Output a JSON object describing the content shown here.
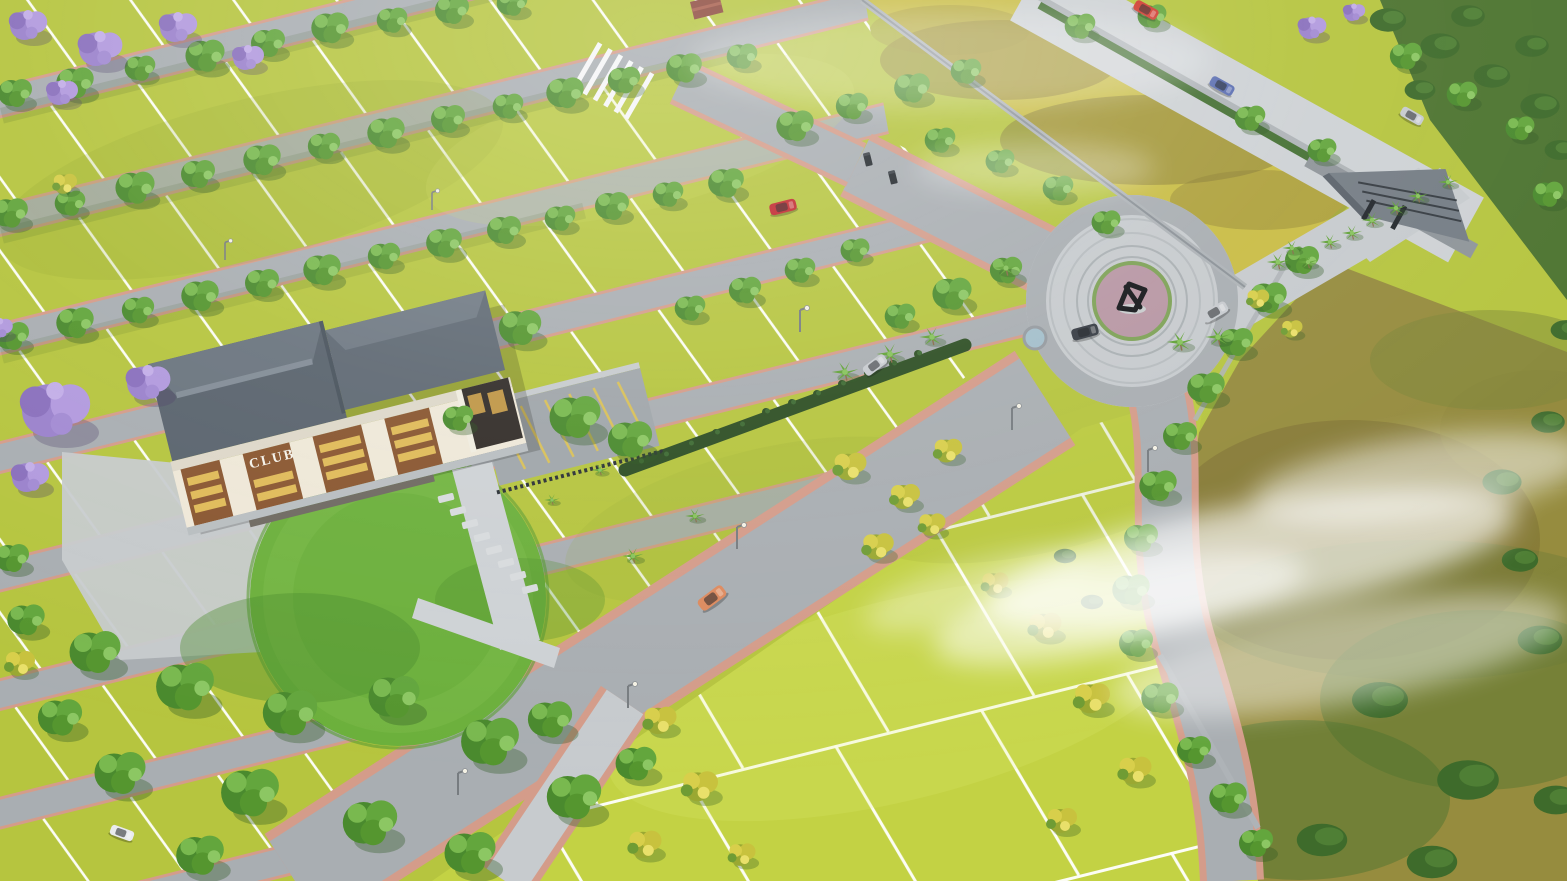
{
  "scene": {
    "description": "Aerial 3D render of a gated plotted land development with clubhouse, roundabout sculpture, entrance gate, tree-lined roads and open plots",
    "club_sign": "CLUB"
  },
  "palette": {
    "plot": "#b6c53f",
    "plot2": "#c3d244",
    "road": "#a9aeb2",
    "pave": "#c7cbce",
    "paveLight": "#ced2d5",
    "edge": "#d49c8a",
    "lawn": "#6cb03c",
    "lawnDark": "#4c8c2c",
    "roof": "#5a646e",
    "roofLight": "#6b757f",
    "ridge": "#838d97",
    "fascia": "#ded8c9",
    "facade": "#efe8d8",
    "panelBrown": "#8a5731",
    "window": "#e9c75e",
    "porch": "#332e2a",
    "wall": "#aeb3b7",
    "wallDark": "#7e858b",
    "terrain": "#968c3e",
    "terrainBrown": "#7d6f33",
    "forest": "#4d7430",
    "hedge": "#3e6b2b",
    "treeDark": "#4a8a2e",
    "treeMid": "#63a63d",
    "treeLight": "#8cc763",
    "yellowTree": "#d8cf4b",
    "palm": "#61a337",
    "jacaranda": "#a38bd3",
    "flowerbed": "#b897a4",
    "sculpture": "#16181b",
    "pond": "#a4bfcb",
    "median": "#2e4f24",
    "fence": "#2c3136",
    "stall": "#d8c05a",
    "stone": "#d8dbdd",
    "signText": "#f5f2ea",
    "mist": "#ffffff",
    "carRed": "#c1272d",
    "carRed2": "#d03a2e",
    "carBlue": "#5c6fb2",
    "carSilver": "#c7cbcf",
    "carOrange": "#dd8a5e",
    "carDark": "#383d44",
    "carWhite": "#e9ebee"
  },
  "objects": {
    "clubhouse": {
      "sign": "CLUB",
      "roof": "gray hip roof",
      "facade": "cream with brown panels and lit windows"
    },
    "roundabout": {
      "feature": "dark abstract sculpture on flower island"
    },
    "entrance_gate": {
      "style": "angular gray canopy with palm-lined driveway"
    },
    "cars": [
      {
        "name": "car-red",
        "location": "plot road"
      },
      {
        "name": "car-orange",
        "location": "main avenue"
      },
      {
        "name": "car-silver-avenue",
        "location": "main avenue"
      },
      {
        "name": "car-dark",
        "location": "roundabout"
      },
      {
        "name": "car-silver-roundabout",
        "location": "roundabout exit"
      },
      {
        "name": "car-red-external",
        "location": "external road"
      },
      {
        "name": "car-blue-external",
        "location": "external road"
      },
      {
        "name": "car-silver-external",
        "location": "external road"
      },
      {
        "name": "car-white-parked",
        "location": "clubhouse path"
      }
    ]
  },
  "stamps": [
    {
      "layer": "median-shrubs",
      "symbol": "#shrubS",
      "name": "median-shrub",
      "items": [
        [
          640,
          462,
          0.5
        ],
        [
          665,
          455,
          0.5
        ],
        [
          690,
          444,
          0.5
        ],
        [
          716,
          433,
          0.5
        ],
        [
          741,
          425,
          0.5
        ],
        [
          766,
          412,
          0.5
        ],
        [
          792,
          403,
          0.5
        ],
        [
          817,
          394,
          0.5
        ],
        [
          842,
          384,
          0.5
        ],
        [
          868,
          373,
          0.5
        ],
        [
          893,
          364,
          0.5
        ],
        [
          918,
          354,
          0.5
        ]
      ]
    },
    {
      "layer": "stepping-stones",
      "symbol": "#stone",
      "name": "stepping-stone",
      "items": [
        [
          446,
          498
        ],
        [
          458,
          511
        ],
        [
          470,
          524
        ],
        [
          482,
          537
        ],
        [
          494,
          550
        ],
        [
          506,
          563
        ],
        [
          518,
          576
        ],
        [
          530,
          589
        ]
      ]
    },
    {
      "layer": "green-trees",
      "symbol": "#treeG",
      "name": "green-tree",
      "items": [
        [
          15,
          95,
          1
        ],
        [
          75,
          85,
          1.1
        ],
        [
          140,
          70,
          0.9
        ],
        [
          205,
          58,
          1.15
        ],
        [
          268,
          45,
          1
        ],
        [
          330,
          30,
          1.1
        ],
        [
          392,
          22,
          0.9
        ],
        [
          452,
          12,
          1
        ],
        [
          512,
          5,
          0.9
        ],
        [
          10,
          215,
          1.05
        ],
        [
          70,
          205,
          0.9
        ],
        [
          135,
          190,
          1.15
        ],
        [
          198,
          176,
          1
        ],
        [
          262,
          162,
          1.1
        ],
        [
          324,
          148,
          0.95
        ],
        [
          386,
          135,
          1.1
        ],
        [
          448,
          121,
          1
        ],
        [
          508,
          108,
          0.9
        ],
        [
          565,
          95,
          1.1
        ],
        [
          624,
          82,
          0.95
        ],
        [
          684,
          70,
          1.05
        ],
        [
          742,
          58,
          0.9
        ],
        [
          12,
          338,
          1
        ],
        [
          75,
          325,
          1.1
        ],
        [
          138,
          312,
          0.95
        ],
        [
          200,
          298,
          1.1
        ],
        [
          262,
          285,
          1
        ],
        [
          322,
          272,
          1.1
        ],
        [
          384,
          258,
          0.95
        ],
        [
          444,
          245,
          1.05
        ],
        [
          504,
          232,
          1
        ],
        [
          560,
          220,
          0.9
        ],
        [
          612,
          208,
          1
        ],
        [
          668,
          196,
          0.9
        ],
        [
          726,
          185,
          1.05
        ],
        [
          795,
          128,
          1.1
        ],
        [
          852,
          108,
          0.95
        ],
        [
          912,
          90,
          1.05
        ],
        [
          966,
          73,
          0.9
        ],
        [
          940,
          142,
          0.9
        ],
        [
          1000,
          163,
          0.85
        ],
        [
          1058,
          190,
          0.9
        ],
        [
          1106,
          224,
          0.85
        ],
        [
          690,
          310,
          0.9
        ],
        [
          745,
          292,
          0.95
        ],
        [
          800,
          272,
          0.9
        ],
        [
          855,
          252,
          0.85
        ],
        [
          520,
          330,
          1.25
        ],
        [
          575,
          420,
          1.5
        ],
        [
          630,
          442,
          1.3
        ],
        [
          458,
          420,
          0.9
        ],
        [
          900,
          318,
          0.9
        ],
        [
          952,
          296,
          1.15
        ],
        [
          1006,
          272,
          0.95
        ],
        [
          1080,
          28,
          0.9
        ],
        [
          1152,
          18,
          0.85
        ],
        [
          1250,
          120,
          0.9
        ],
        [
          1322,
          152,
          0.85
        ],
        [
          1406,
          58,
          0.95
        ],
        [
          1462,
          96,
          0.9
        ],
        [
          1520,
          130,
          0.85
        ],
        [
          1548,
          196,
          0.9
        ],
        [
          1302,
          262,
          1
        ],
        [
          1268,
          300,
          1.1
        ],
        [
          1236,
          344,
          1
        ],
        [
          1206,
          390,
          1.1
        ],
        [
          1180,
          438,
          1
        ],
        [
          1158,
          488,
          1.1
        ],
        [
          1141,
          540,
          1
        ],
        [
          1131,
          592,
          1.1
        ],
        [
          1136,
          645,
          1
        ],
        [
          1160,
          700,
          1.1
        ],
        [
          1194,
          752,
          1
        ],
        [
          1228,
          800,
          1.1
        ],
        [
          1256,
          845,
          1
        ],
        [
          95,
          655,
          1.5
        ],
        [
          185,
          690,
          1.7
        ],
        [
          290,
          716,
          1.6
        ],
        [
          394,
          700,
          1.5
        ],
        [
          490,
          745,
          1.7
        ],
        [
          574,
          800,
          1.6
        ],
        [
          250,
          796,
          1.7
        ],
        [
          370,
          826,
          1.6
        ],
        [
          120,
          776,
          1.5
        ],
        [
          200,
          858,
          1.4
        ],
        [
          470,
          856,
          1.5
        ],
        [
          60,
          720,
          1.3
        ],
        [
          550,
          722,
          1.3
        ],
        [
          636,
          766,
          1.2
        ],
        [
          12,
          560,
          1
        ],
        [
          26,
          622,
          1.1
        ]
      ]
    },
    {
      "layer": "yellow-trees",
      "symbol": "#treeY",
      "name": "yellow-flowering-tree",
      "items": [
        [
          850,
          468,
          1.1
        ],
        [
          905,
          498,
          1
        ],
        [
          948,
          452,
          0.95
        ],
        [
          878,
          548,
          1.05
        ],
        [
          932,
          526,
          0.9
        ],
        [
          995,
          585,
          0.9
        ],
        [
          660,
          722,
          1.1
        ],
        [
          700,
          788,
          1.2
        ],
        [
          645,
          846,
          1.1
        ],
        [
          742,
          856,
          0.9
        ],
        [
          1045,
          628,
          1.1
        ],
        [
          1092,
          700,
          1.2
        ],
        [
          1135,
          772,
          1.1
        ],
        [
          1062,
          822,
          1
        ],
        [
          20,
          665,
          1
        ],
        [
          65,
          185,
          0.8
        ],
        [
          1258,
          300,
          0.75
        ],
        [
          1292,
          330,
          0.7
        ]
      ]
    },
    {
      "layer": "palm-trees",
      "symbol": "#palm",
      "name": "palm-tree",
      "items": [
        [
          845,
          372,
          0.95
        ],
        [
          890,
          354,
          0.95
        ],
        [
          932,
          337,
          0.9
        ],
        [
          1006,
          268,
          0.85
        ],
        [
          1180,
          342,
          0.95
        ],
        [
          1218,
          337,
          0.9
        ],
        [
          1278,
          262,
          0.8
        ],
        [
          1292,
          248,
          0.7
        ],
        [
          1308,
          262,
          0.7
        ],
        [
          1330,
          242,
          0.72
        ],
        [
          1352,
          233,
          0.72
        ],
        [
          1372,
          220,
          0.74
        ],
        [
          1396,
          208,
          0.74
        ],
        [
          1418,
          196,
          0.72
        ],
        [
          1448,
          182,
          0.7
        ],
        [
          633,
          556,
          0.75
        ],
        [
          695,
          516,
          0.7
        ],
        [
          600,
          470,
          0.6
        ],
        [
          552,
          500,
          0.55
        ]
      ]
    },
    {
      "layer": "jacaranda-trees",
      "symbol": "#jac",
      "name": "jacaranda-tree",
      "items": [
        [
          28,
          28,
          1.2
        ],
        [
          100,
          52,
          1.4
        ],
        [
          178,
          30,
          1.2
        ],
        [
          248,
          60,
          1
        ],
        [
          62,
          95,
          1
        ],
        [
          0,
          330,
          0.8
        ],
        [
          55,
          415,
          2.2
        ],
        [
          148,
          386,
          1.4
        ],
        [
          30,
          480,
          1.2
        ],
        [
          1312,
          30,
          0.9
        ],
        [
          1354,
          14,
          0.7
        ]
      ]
    },
    {
      "layer": "hedge-blobs",
      "symbol": "#hedgeB",
      "name": "hedge",
      "items": [
        [
          1388,
          20,
          1.3
        ],
        [
          1440,
          46,
          1.4
        ],
        [
          1492,
          76,
          1.3
        ],
        [
          1540,
          106,
          1.4
        ],
        [
          1468,
          16,
          1.2
        ],
        [
          1532,
          46,
          1.2
        ],
        [
          1560,
          150,
          1.1
        ],
        [
          1420,
          90,
          1.1
        ],
        [
          1380,
          700,
          2
        ],
        [
          1468,
          780,
          2.2
        ],
        [
          1322,
          840,
          1.8
        ],
        [
          1540,
          640,
          1.6
        ],
        [
          1432,
          862,
          1.8
        ],
        [
          1556,
          800,
          1.6
        ],
        [
          1502,
          482,
          1.4
        ],
        [
          1548,
          422,
          1.2
        ],
        [
          1065,
          556,
          0.8
        ],
        [
          1092,
          602,
          0.8
        ],
        [
          1566,
          330,
          1.1
        ],
        [
          1520,
          560,
          1.3
        ]
      ]
    }
  ]
}
